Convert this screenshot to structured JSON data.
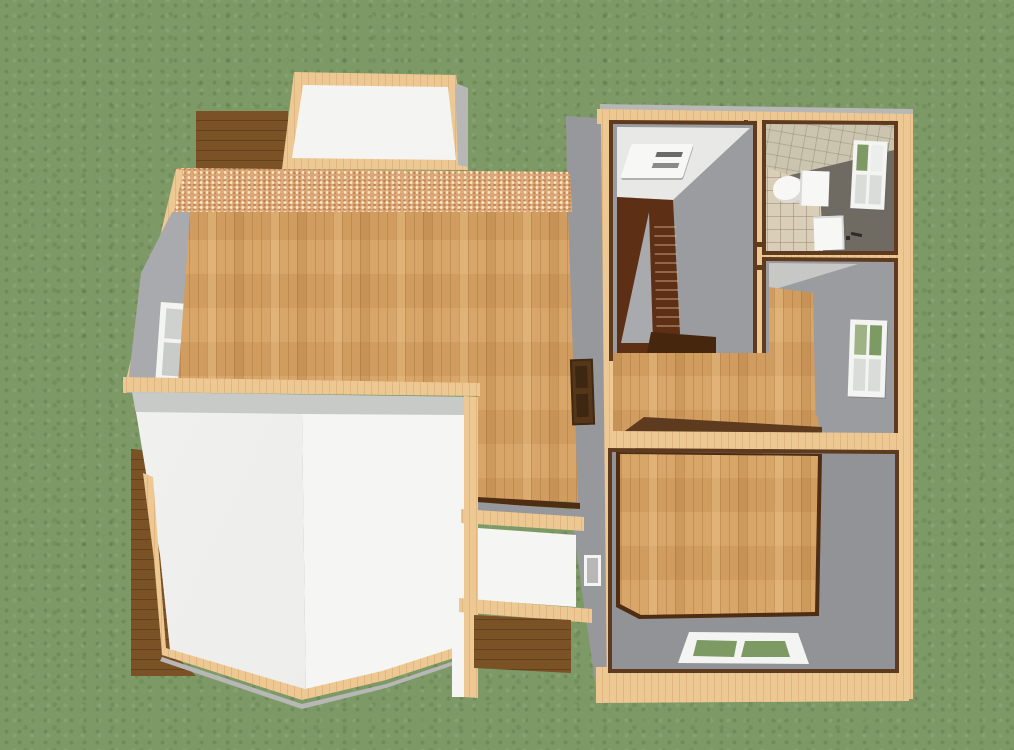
{
  "scene": {
    "view": "overhead-3d-dollhouse-render",
    "viewport": {
      "width": 1014,
      "height": 750
    },
    "ground": "grass-lawn",
    "buildings": {
      "main_house": {
        "features": [
          "dormer-roof",
          "upper-deck",
          "osb-sheathing-band",
          "open-wood-floor",
          "left-wall-window",
          "bay-roof",
          "side-deck",
          "porch-roof",
          "deck-steps",
          "entry-door"
        ]
      },
      "right_wing": {
        "rooms": [
          "stairwell",
          "bathroom",
          "hall",
          "middle-room",
          "bottom-room"
        ],
        "fixtures": [
          "ceiling-light",
          "staircase",
          "toilet",
          "sink",
          "bathroom-window",
          "middle-room-window",
          "bottom-room-window",
          "west-wall-opening"
        ]
      }
    }
  },
  "palette": {
    "grass": "#7d9a66",
    "wood": "#d7a263",
    "plate": "#eec893",
    "osb": "#dcaa7c",
    "trim": "#5e3a1e",
    "line-dark": "#4f2d12",
    "wall-gray": "#9b9ca0",
    "wall-gray-light": "#a9aaae",
    "west-gray": "#97989c",
    "metal-gray": "#b7b8b6",
    "fascia": "#c8cac8",
    "ceiling-white": "#e6e6e4",
    "roof-white": "#f5f5f3",
    "roof-shade": "#ececea",
    "deck": "#7b5226",
    "stair": "#5d3016",
    "stair-dark": "#47260e",
    "bath-wall": "#6f6b63",
    "tile-floor": "#d9ceb8",
    "tile-ceiling": "#cbc5b0",
    "fixture-white": "#f7f7f5",
    "fixture-shadow": "#d9d9d7",
    "frame-white": "#f4f4f2",
    "glass-green": "#7e9a64",
    "pane-light": "#dadcd9",
    "pane-shade": "#c9cbc8",
    "door": "#563619"
  }
}
